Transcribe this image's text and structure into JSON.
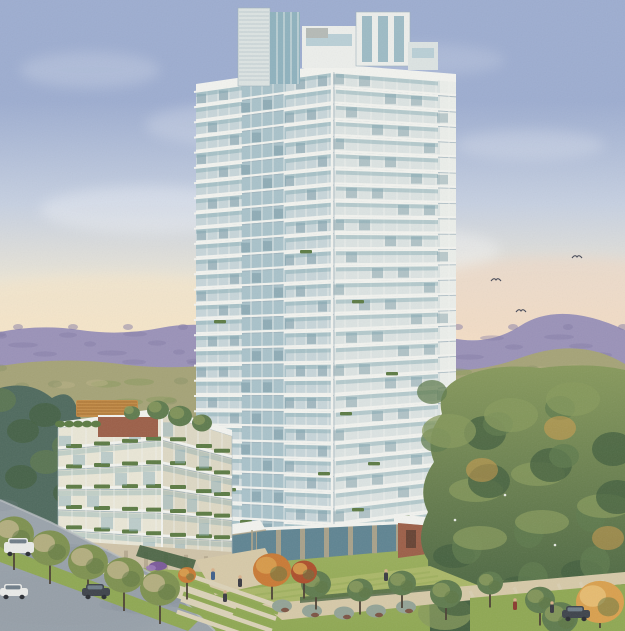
{
  "scene": {
    "description": "Watercolor architectural rendering of a glass residential condominium tower (approx. 30 storeys) with a 6-storey podium building, rooftop garden, landscaped entry plaza with steps, tree-lined street with cars, parkland and forest to the right, birds in a dusk sky. No text appears in the image.",
    "style": "watercolor illustration",
    "visible_text": "none"
  },
  "palette": {
    "sky_top": "#9dadd0",
    "sky_mid": "#c6d0e1",
    "sky_low": "#e9e4d6",
    "horizon_glow": "#f6e5c8",
    "horizon_pink": "#f0d5c2",
    "ridge": "#9a92b8",
    "ridge_dark": "#837ba6",
    "olive": "#a5a377",
    "olive_dark": "#8a9265",
    "olive_light": "#bcb387",
    "haze_blue": "#8e9aa8",
    "forest": "#5f7b4e",
    "forest_dark": "#435f3f",
    "forest_light": "#87995c",
    "forest_blue": "#4f6a5e",
    "tower_light": "#eceeeb",
    "tower_mid": "#dce3e2",
    "tower_shadow": "#c7d5d9",
    "mullion": "#f2f3ef",
    "slab_shadow": "#9fb2bc",
    "glass_light": "#b9cfd6",
    "glass_mid": "#8fb2be",
    "glass_dark": "#5f8492",
    "glass_teal": "#79a3ad",
    "podium_cream": "#e9e6d6",
    "stone": "#cfc3a8",
    "stone_dark": "#b0a489",
    "brick": "#9c5f48",
    "pergola": "#c68a42",
    "planter_green": "#5c7b44",
    "grass": "#8fa853",
    "grass_light": "#aab768",
    "sidewalk": "#dbd2b8",
    "path": "#d6c9a8",
    "road": "#9aa3ab",
    "road_dark": "#828c96",
    "road_light": "#b8bdc0",
    "autumn_orange": "#c97a35",
    "autumn_red": "#ad4f2c",
    "autumn_gold": "#d9a04e",
    "street_tree": "#7e9150",
    "street_tree_dark": "#5d7542",
    "trunk": "#4b4034",
    "car_white": "#e9eae8",
    "car_dark": "#3e434b",
    "car_glass": "#6f7d88",
    "figure_blue": "#3f5f8a",
    "figure_dark": "#3a3a42",
    "figure_red": "#8a3a2e",
    "bird": "#474a58",
    "shrub_gray": "#93a396",
    "shrub_red": "#77402f"
  },
  "tower": {
    "storeys": 30,
    "left_face": {
      "xL": 196,
      "xR": 332,
      "yTopL": 90,
      "yTopR": 70,
      "yBotL": 546,
      "yBotR": 556,
      "gap": 11,
      "balcony_zones": [
        [
          196,
          242
        ],
        [
          286,
          332
        ]
      ],
      "curtain": [
        242,
        286
      ]
    },
    "right_face": {
      "xL": 332,
      "xR": 456,
      "yTopL": 70,
      "yTopR": 80,
      "yBotL": 556,
      "yBotR": 538,
      "gap": 13,
      "balcony_zones": [
        [
          336,
          438
        ]
      ],
      "end_bay": [
        440,
        456
      ]
    },
    "planters": [
      [
        212,
        450
      ],
      [
        224,
        488
      ],
      [
        204,
        515
      ],
      [
        240,
        520
      ],
      [
        300,
        528
      ],
      [
        318,
        472
      ],
      [
        352,
        508
      ],
      [
        368,
        462
      ],
      [
        398,
        515
      ],
      [
        300,
        250
      ],
      [
        214,
        320
      ],
      [
        352,
        300
      ],
      [
        340,
        412
      ],
      [
        386,
        372
      ]
    ]
  },
  "podium": {
    "storeys": 6,
    "left_face": {
      "xL": 58,
      "xR": 162,
      "yTopL": 428,
      "yTopR": 414,
      "yBotL": 548,
      "yBotR": 560,
      "gap": 14
    },
    "right_face": {
      "xL": 162,
      "xR": 232,
      "yTopL": 414,
      "yTopR": 436,
      "yBotL": 560,
      "yBotR": 560,
      "gap": 12
    },
    "planter_cols_left": [
      66,
      94,
      122,
      146
    ],
    "planter_cols_right": [
      170,
      196,
      214
    ],
    "roof_trees": [
      [
        158,
        410,
        11
      ],
      [
        180,
        416,
        12
      ],
      [
        202,
        423,
        10
      ],
      [
        132,
        413,
        8
      ]
    ]
  },
  "street_trees": [
    [
      14,
      534
    ],
    [
      50,
      548
    ],
    [
      88,
      562
    ],
    [
      124,
      575
    ],
    [
      160,
      588
    ]
  ],
  "park_trees": [
    [
      316,
      584,
      15
    ],
    [
      360,
      590,
      13
    ],
    [
      402,
      583,
      14
    ],
    [
      446,
      594,
      16
    ],
    [
      490,
      583,
      13
    ],
    [
      540,
      600,
      15
    ]
  ],
  "foreground_trees": [
    [
      600,
      602,
      24,
      "gold"
    ],
    [
      560,
      618,
      18,
      "green"
    ]
  ],
  "autumn_trees": [
    [
      272,
      570,
      19
    ],
    [
      304,
      572,
      13
    ],
    [
      187,
      575,
      9
    ]
  ],
  "forest_autumn_accents": [
    [
      482,
      470
    ],
    [
      560,
      428
    ],
    [
      608,
      538
    ]
  ],
  "gray_shrubs": [
    [
      282,
      606
    ],
    [
      312,
      611
    ],
    [
      344,
      613
    ],
    [
      376,
      611
    ],
    [
      406,
      607
    ]
  ],
  "birds": [
    [
      577,
      258
    ],
    [
      496,
      281
    ],
    [
      521,
      312
    ]
  ],
  "clouds": [
    [
      90,
      70,
      70,
      18,
      0.18
    ],
    [
      240,
      125,
      95,
      22,
      0.2
    ],
    [
      420,
      60,
      85,
      16,
      0.15
    ],
    [
      530,
      145,
      75,
      15,
      0.2
    ],
    [
      150,
      210,
      110,
      24,
      0.28
    ],
    [
      360,
      250,
      140,
      26,
      0.3
    ]
  ],
  "cars": [
    {
      "kind": "van",
      "x": 4,
      "y": 538,
      "dark": false
    },
    {
      "kind": "car",
      "x": 0,
      "y": 584,
      "dark": false
    },
    {
      "kind": "car",
      "x": 82,
      "y": 584,
      "dark": true
    },
    {
      "kind": "car",
      "x": 562,
      "y": 606,
      "dark": true
    }
  ],
  "pedestrians": [
    [
      213,
      570,
      "figure_blue"
    ],
    [
      240,
      577,
      "figure_dark"
    ],
    [
      386,
      571,
      "figure_dark"
    ],
    [
      515,
      600,
      "figure_red"
    ],
    [
      552,
      603,
      "figure_dark"
    ],
    [
      225,
      592,
      "figure_dark"
    ]
  ]
}
